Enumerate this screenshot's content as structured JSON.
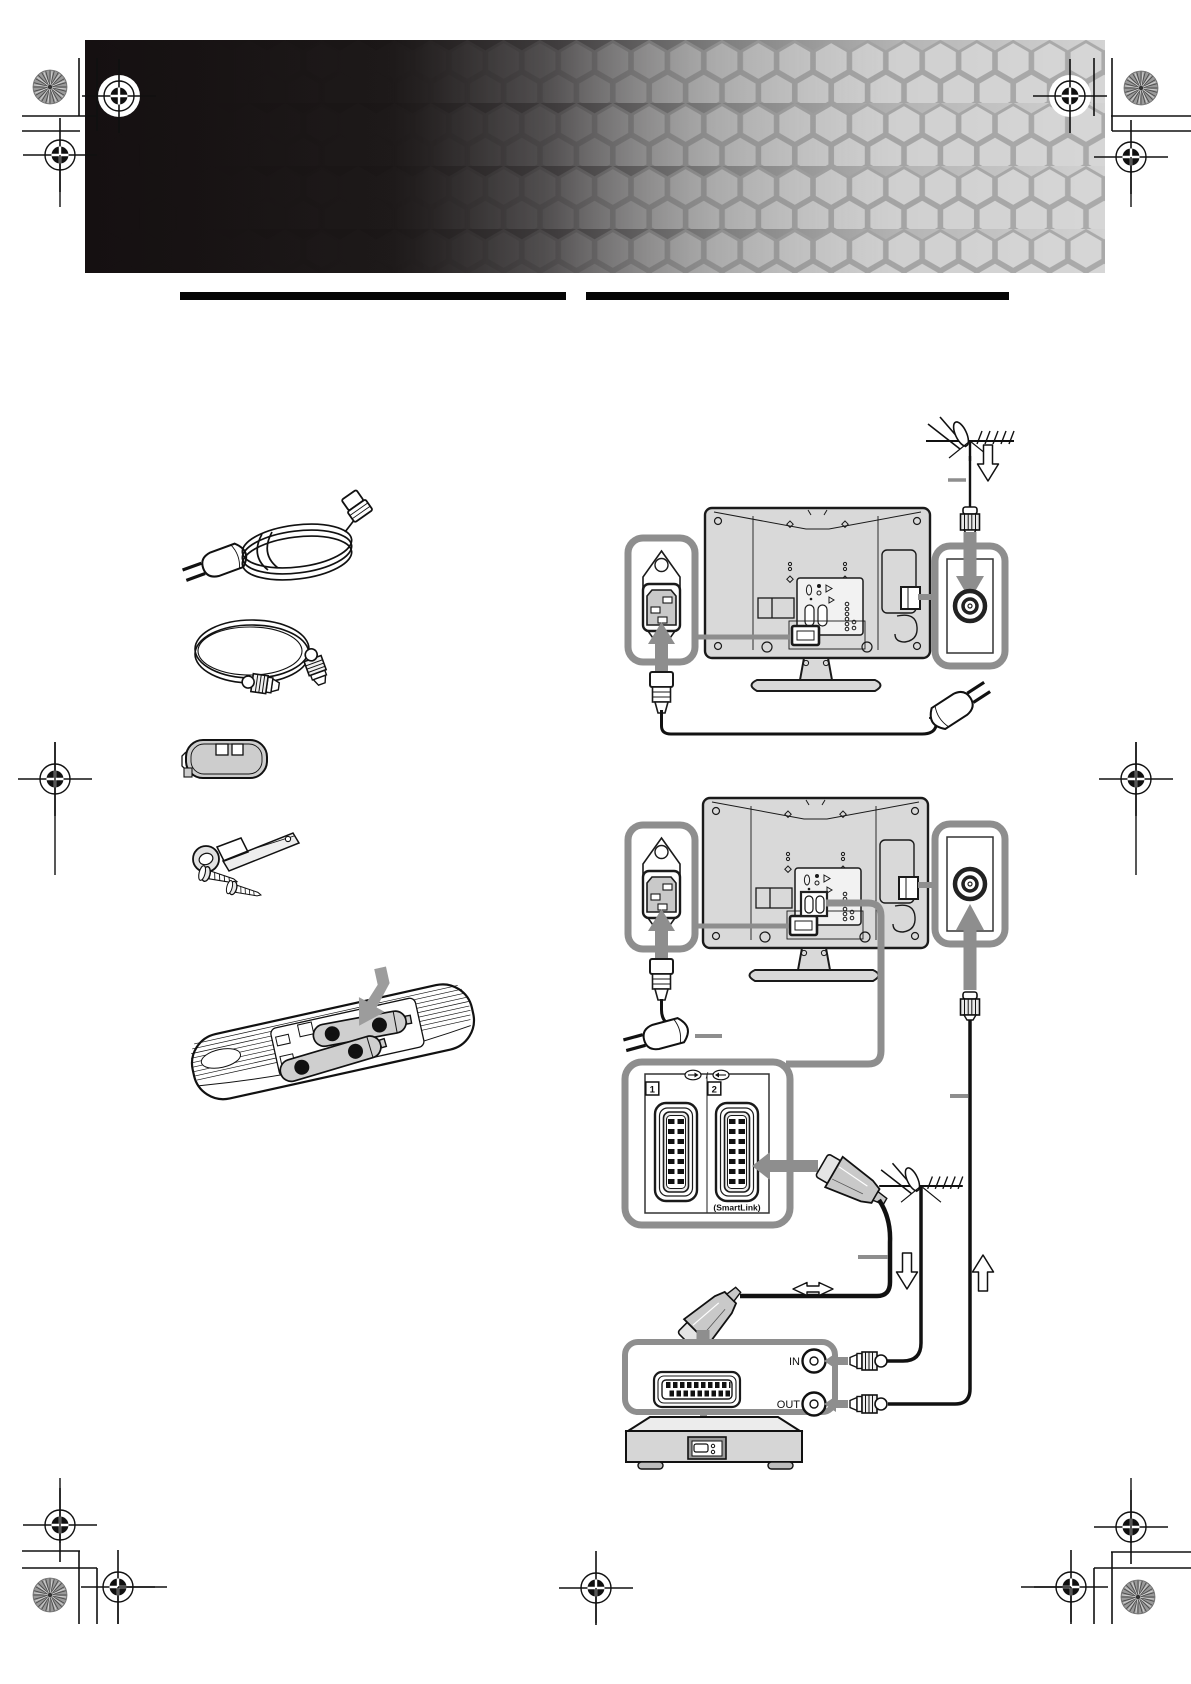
{
  "document": {
    "kind": "tv-instruction-manual-page",
    "visible_text_items": [
      "1",
      "2",
      "(SmartLink)",
      "IN",
      "OUT",
      "+",
      "−",
      "/"
    ]
  },
  "labels": {
    "scart_socket1": "1",
    "scart_socket2": "2",
    "smartlink": "(SmartLink)",
    "vcr_in": "IN",
    "vcr_out": "OUT",
    "io_separator": "/"
  },
  "remote": {
    "battery1_left": "−",
    "battery1_right": "+",
    "battery2_left": "+",
    "battery2_right": "−"
  },
  "icons": {
    "accessories": [
      "mains-lead-icon",
      "coaxial-cable-icon",
      "cable-holder-icon",
      "support-belt-screws-icon",
      "remote-with-batteries-icon"
    ],
    "diagrams": [
      "aerial-antenna-icon",
      "coax-plug-icon",
      "mains-socket-icon",
      "mains-plug-icon",
      "aerial-socket-icon",
      "scart-socket-icon",
      "scart-plug-icon",
      "vcr-icon",
      "flow-arrow-icons",
      "print-registration-icons"
    ]
  },
  "colors": {
    "page_bg": "#ffffff",
    "banner_dark": "#151011",
    "banner_light": "#d3d3d3",
    "section_bar": "#050505",
    "callout_border": "#8e8e8e",
    "arrow_gray": "#8e8e8e",
    "device_fill": "#d9d9d9",
    "line": "#111111"
  }
}
